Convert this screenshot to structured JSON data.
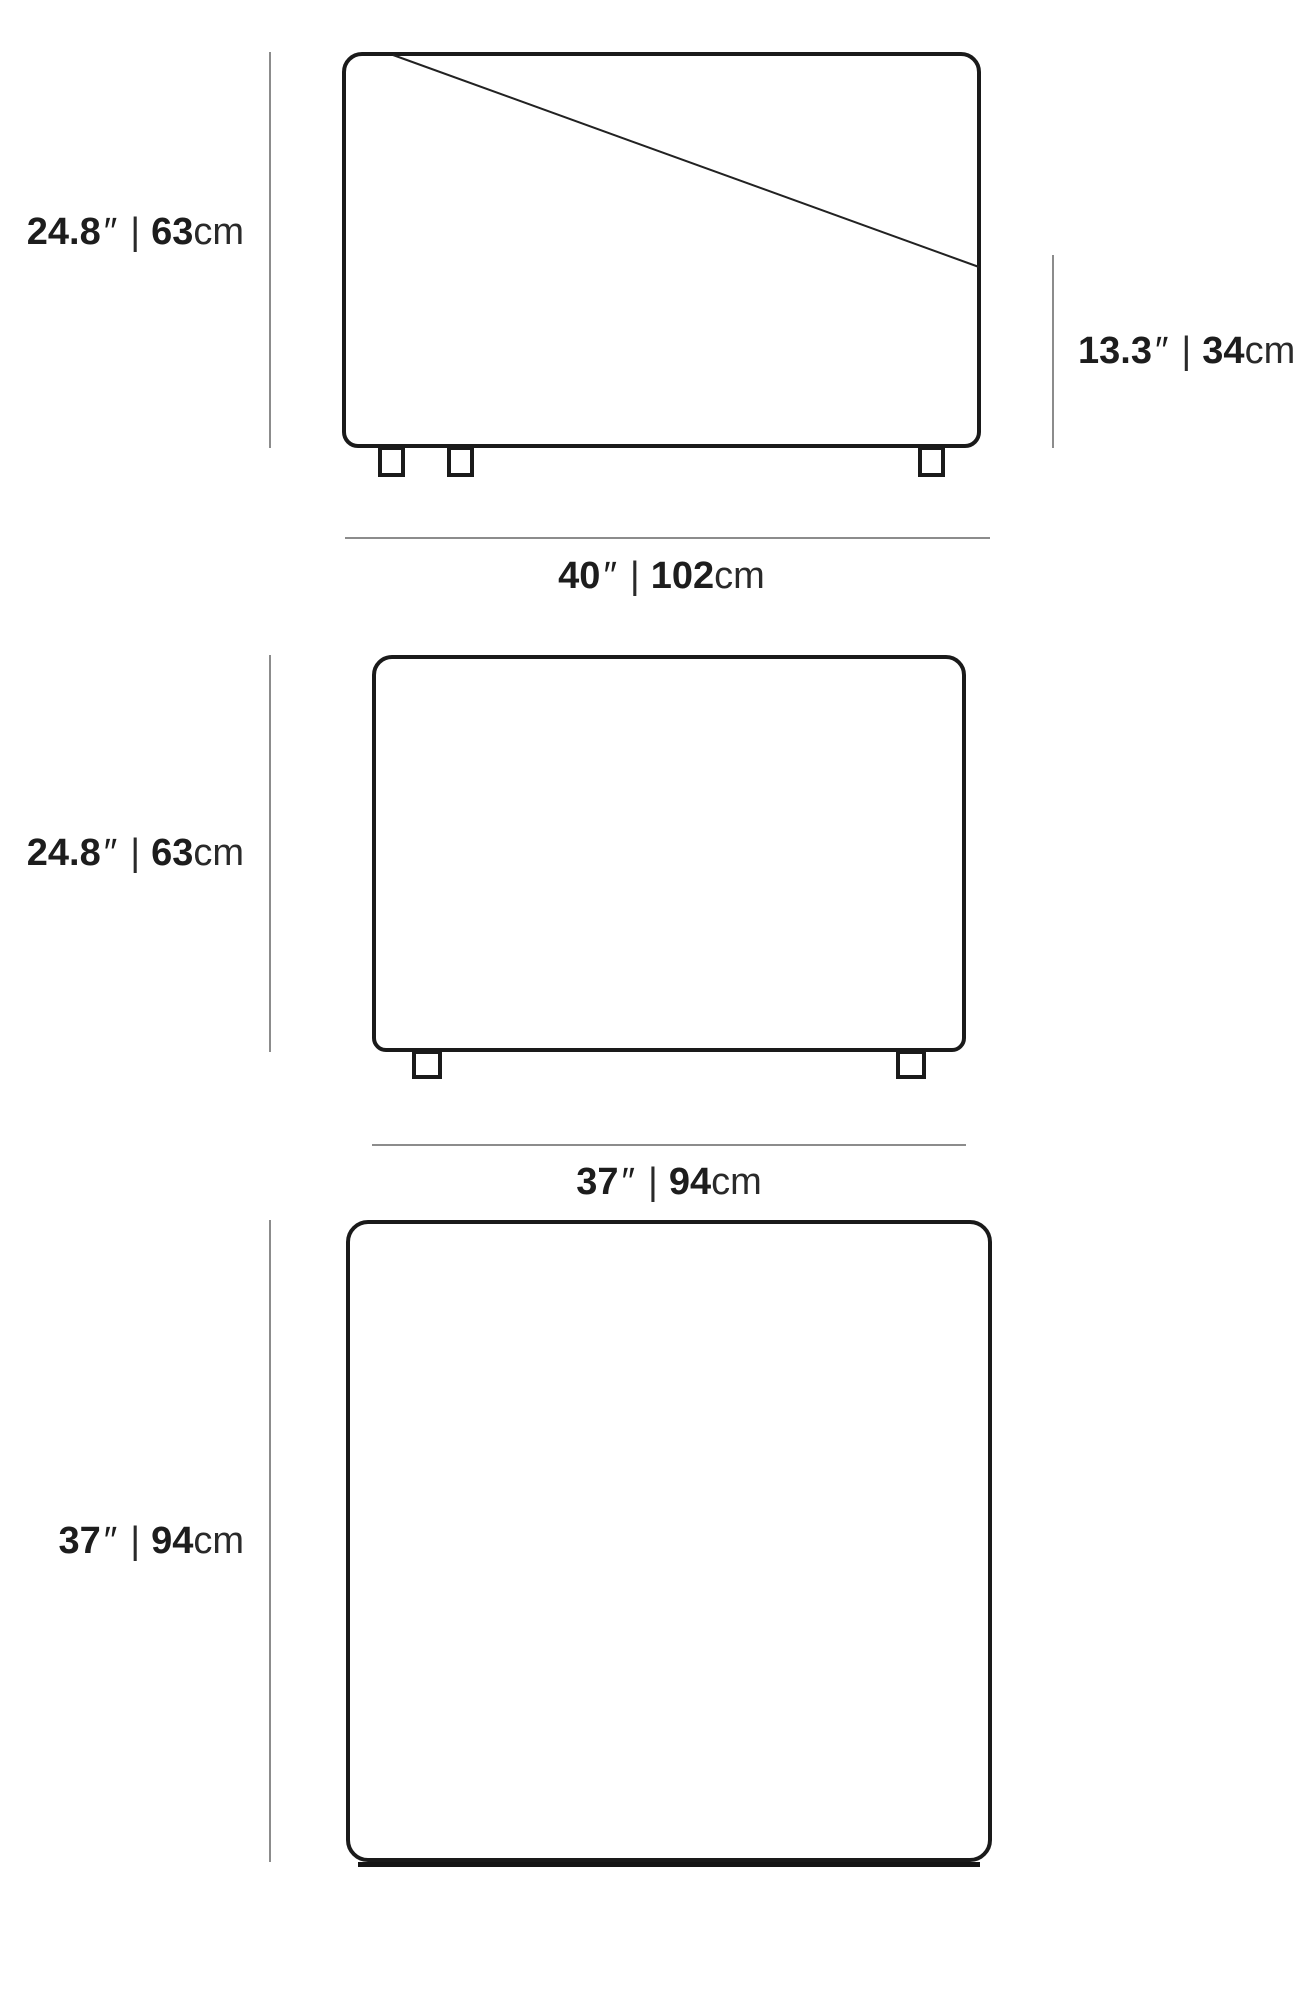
{
  "units": {
    "inch_mark": "″",
    "separator": "|",
    "cm": "cm"
  },
  "figures": {
    "front_view": {
      "overall_height": {
        "in": "24.8",
        "cm": "63"
      },
      "seat_height": {
        "in": "13.3",
        "cm": "34"
      },
      "overall_width": {
        "in": "40",
        "cm": "102"
      }
    },
    "side_view": {
      "overall_height": {
        "in": "24.8",
        "cm": "63"
      },
      "overall_depth": {
        "in": "37",
        "cm": "94"
      }
    },
    "top_view": {
      "overall_depth": {
        "in": "37",
        "cm": "94"
      }
    }
  },
  "colors": {
    "outline": "#1a1a1a",
    "dimension_line": "#8c8c8c",
    "text": "#1d1d1d",
    "background": "#ffffff"
  }
}
